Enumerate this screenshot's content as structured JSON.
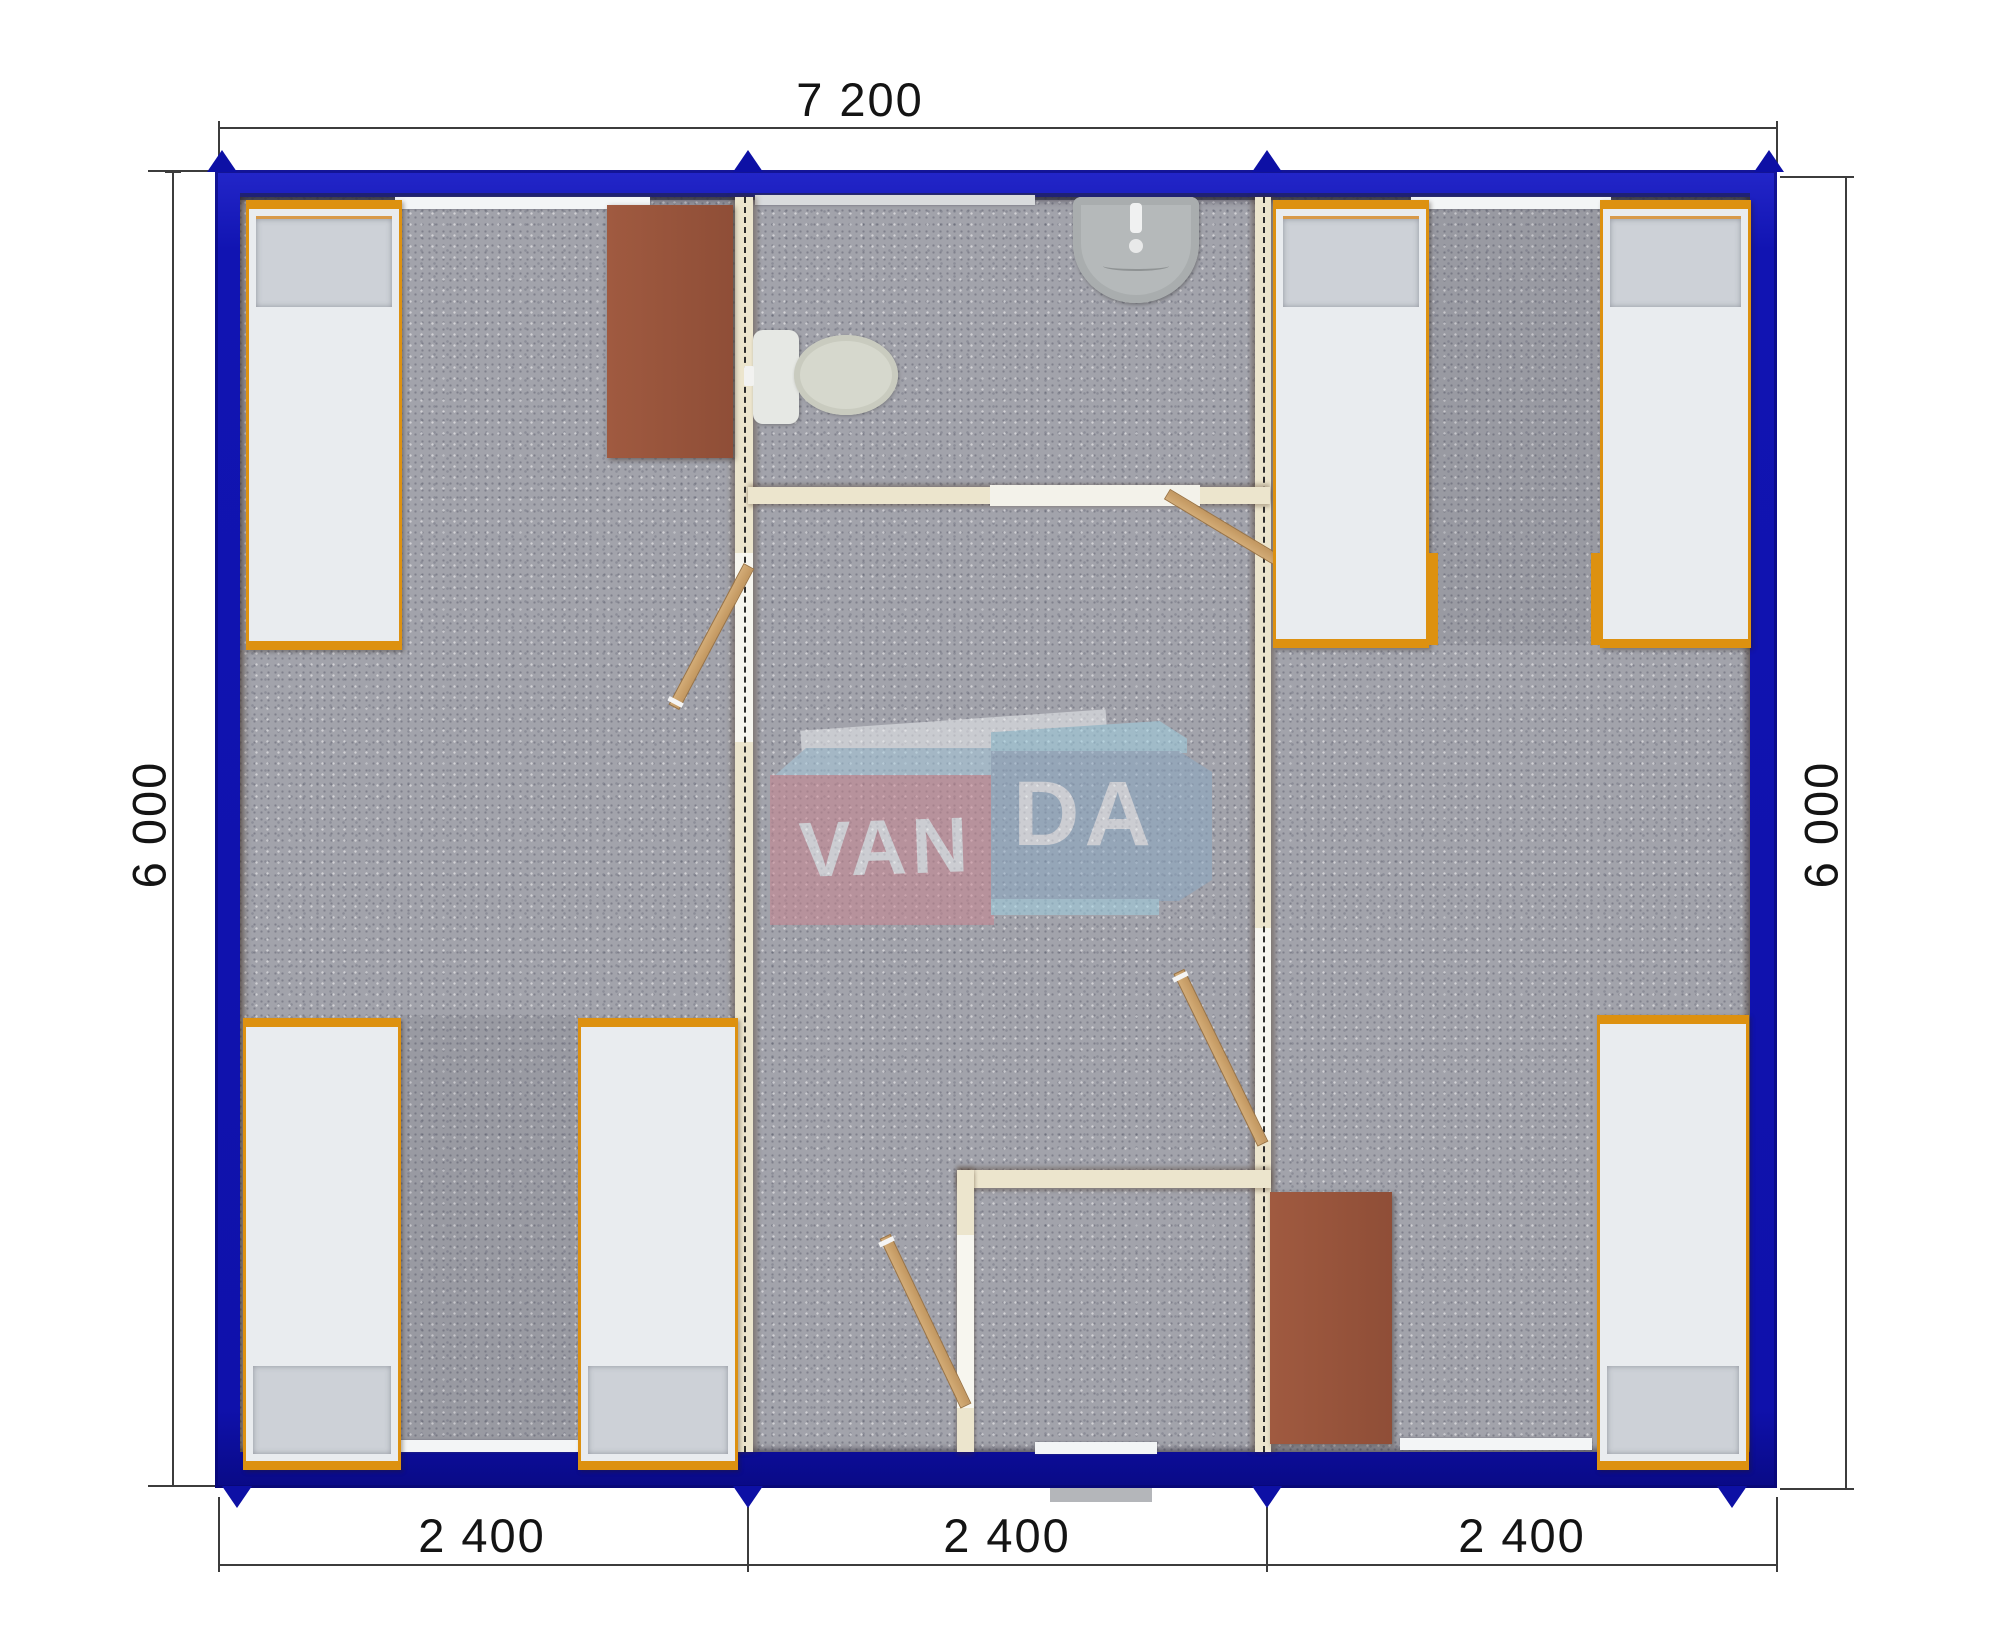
{
  "annotations": {
    "width_total": "7 200",
    "height_left": "6 000",
    "height_right": "6 000",
    "modules": [
      "2 400",
      "2 400",
      "2 400"
    ]
  },
  "watermark": {
    "part1": "VAN",
    "part2": "DA"
  },
  "inventory": {
    "modules": 3,
    "beds": 6,
    "wardrobes": 2,
    "doors": 4,
    "bathroom_fixtures": [
      "toilet",
      "washbasin"
    ],
    "windows": 5
  },
  "colors": {
    "wall_blue": "#1114b2",
    "partition_cream": "#ece5cd",
    "carpet_gray": "#a2a3ab",
    "frame_orange": "#dd9110",
    "cabinet_brown": "#98523a",
    "door_wood": "#c9a26e",
    "logo_red": "#cb8490",
    "logo_steel_blue": "#8ba9c4",
    "logo_light_blue": "#a6cade",
    "dimension_text": "#141414"
  }
}
